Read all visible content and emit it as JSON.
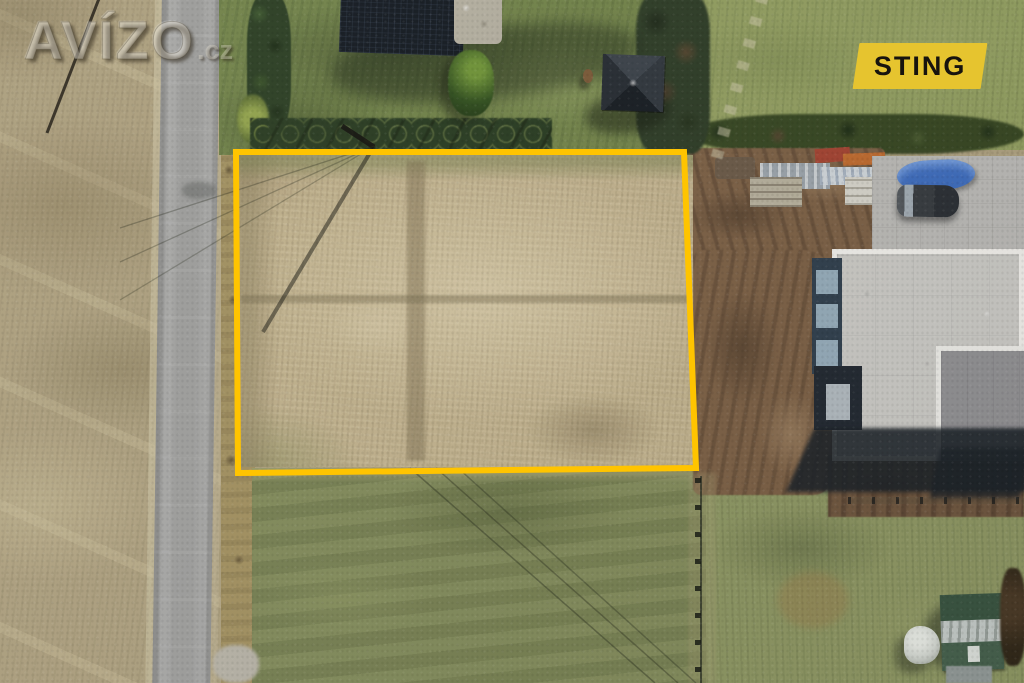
{
  "watermark": {
    "brand": "AVÍZO",
    "suffix": ".cz"
  },
  "badge": {
    "label": "STING"
  },
  "plot_outline": {
    "points": "236,152 684,152 696,468 238,473",
    "color": "#FFC400"
  },
  "colors": {
    "outline_yellow": "#FFC400",
    "badge_yellow": "#E6C42F",
    "badge_text": "#17130E"
  }
}
